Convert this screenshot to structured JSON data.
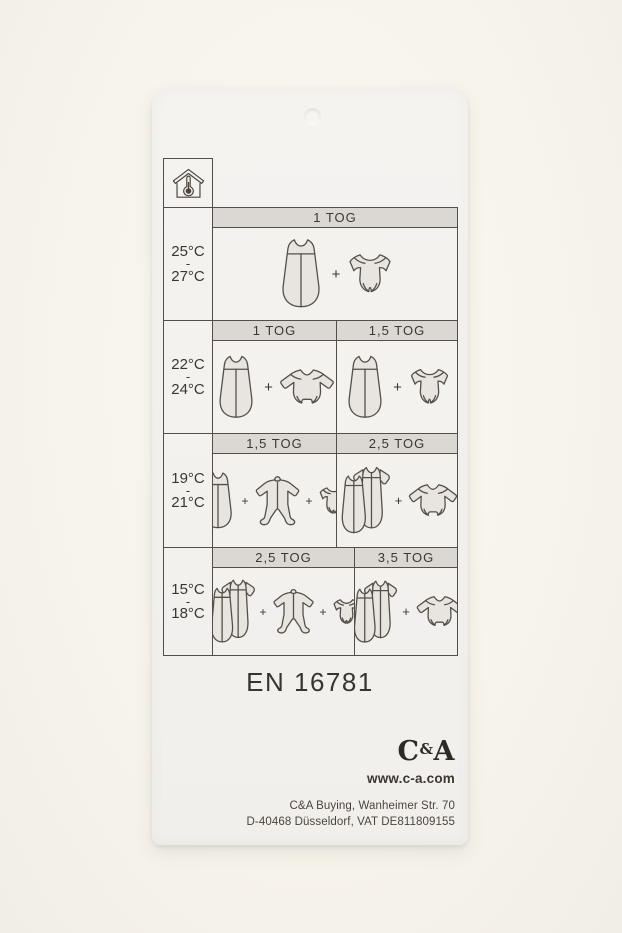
{
  "tag": {
    "plus": "+",
    "rows": [
      {
        "temp_from": "25°C",
        "temp_dash": "-",
        "temp_to": "27°C",
        "cells": [
          {
            "tog": "1 TOG",
            "items": [
              "sleeping-bag",
              "bodysuit-short"
            ]
          }
        ]
      },
      {
        "temp_from": "22°C",
        "temp_dash": "-",
        "temp_to": "24°C",
        "cells": [
          {
            "tog": "1 TOG",
            "items": [
              "sleeping-bag",
              "bodysuit-long"
            ]
          },
          {
            "tog": "1,5 TOG",
            "items": [
              "sleeping-bag",
              "bodysuit-short"
            ]
          }
        ]
      },
      {
        "temp_from": "19°C",
        "temp_dash": "-",
        "temp_to": "21°C",
        "cells": [
          {
            "tog": "1,5 TOG",
            "items": [
              "sleeping-bag",
              "sleepsuit",
              "bodysuit-short"
            ]
          },
          {
            "tog": "2,5 TOG",
            "items": [
              "double-sleeping-bag",
              "bodysuit-long"
            ]
          }
        ]
      },
      {
        "temp_from": "15°C",
        "temp_dash": "-",
        "temp_to": "18°C",
        "cells": [
          {
            "tog": "2,5 TOG",
            "items": [
              "double-sleeping-bag",
              "sleepsuit",
              "bodysuit-short"
            ]
          },
          {
            "tog": "3,5 TOG",
            "items": [
              "double-sleeping-bag",
              "bodysuit-long"
            ]
          }
        ]
      }
    ],
    "standard": "EN 16781",
    "brand": {
      "logo_c": "C",
      "logo_amp": "&",
      "logo_a": "A",
      "website": "www.c-a.com"
    },
    "address": [
      "C&A Buying, Wanheimer Str. 70",
      "D-40468 Düsseldorf, VAT DE811809155"
    ]
  }
}
